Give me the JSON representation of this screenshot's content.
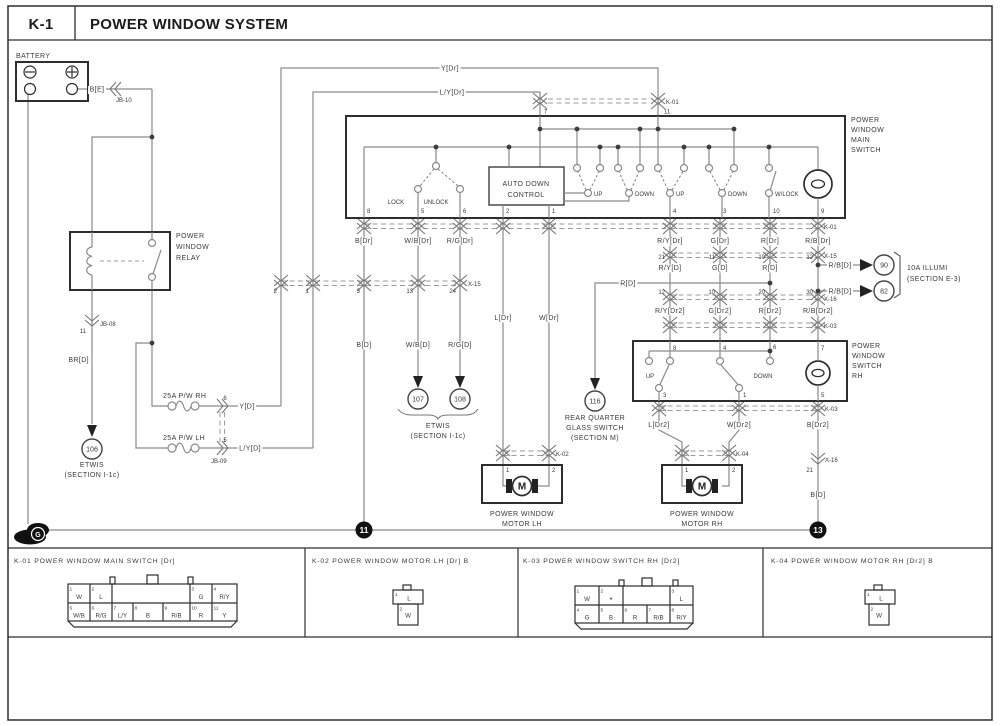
{
  "header": {
    "code": "K-1",
    "title": "POWER WINDOW SYSTEM"
  },
  "battery": {
    "label": "BATTERY",
    "wire_be": "B[E]",
    "jb10": "JB-10"
  },
  "relay": {
    "lines": [
      "POWER",
      "WINDOW",
      "RELAY"
    ],
    "jb08": "JB-08",
    "jb08_pin": "11",
    "wire_brd": "BR[D]"
  },
  "etwis106": {
    "num": "106",
    "lines": [
      "ETWIS",
      "(SECTION I-1c)"
    ]
  },
  "breakers": {
    "rh": "25A P/W RH",
    "lh": "25A P/W LH",
    "pin_rh": "6",
    "pin_lh": "5",
    "jb09": "JB-09",
    "wire_yd": "Y[D]",
    "wire_lyd": "L/Y[D]"
  },
  "top_wires": {
    "y_dr": "Y[Dr]",
    "ly_dr": "L/Y[Dr]"
  },
  "k01_top": {
    "label": "K-01",
    "pin7": "7",
    "pin11": "11"
  },
  "main_switch": {
    "lines": [
      "POWER",
      "WINDOW",
      "MAIN",
      "SWITCH"
    ],
    "lock": "LOCK",
    "unlock": "UNLOCK",
    "adc": [
      "AUTO DOWN",
      "CONTROL"
    ],
    "up": "UP",
    "down": "DOWN",
    "wlock": "W/LOCK",
    "bottom_pins": [
      "8",
      "5",
      "6",
      "2",
      "1",
      "4",
      "3",
      "10",
      "9"
    ]
  },
  "k01_bottom": {
    "label": "K-01"
  },
  "row_dr": [
    "B[Dr]",
    "W/B[Dr]",
    "R/G[Dr]",
    "R/Y[Dr]",
    "G[Dr]",
    "R[Dr]",
    "R/B[Dr]"
  ],
  "x15_left": {
    "label": "X-15",
    "pins": [
      "2",
      "1",
      "3",
      "13",
      "24"
    ]
  },
  "x15_right": {
    "label": "X-15",
    "pins": [
      "21",
      "11",
      "10",
      "12"
    ]
  },
  "row_d": [
    "R/Y[D]",
    "G[D]",
    "R[D]"
  ],
  "rb_d": "R/B[D]",
  "r_d": "R[D]",
  "illumi": {
    "n90": "90",
    "n82": "82",
    "lines": [
      "10A ILLUMI",
      "(SECTION E-3)"
    ]
  },
  "x16": {
    "label": "X-16",
    "pins": [
      "12",
      "10",
      "20",
      "30"
    ]
  },
  "row_dr2": [
    "R/Y[Dr2]",
    "G[Dr2]",
    "R[Dr2]",
    "R/B[Dr2]"
  ],
  "k03_top": {
    "label": "K-03"
  },
  "rh_switch": {
    "lines": [
      "POWER",
      "WINDOW",
      "SWITCH",
      "RH"
    ],
    "up": "UP",
    "down": "DOWN",
    "top_pins": [
      "8",
      "4",
      "6",
      "7"
    ],
    "bottom_pins": [
      "3",
      "1",
      "5"
    ]
  },
  "k03_bottom": {
    "label": "K-03"
  },
  "row_dr2b": [
    "L[Dr2]",
    "W[Dr2]",
    "B[Dr2]"
  ],
  "x16_single": {
    "label": "X-16",
    "pin": "21",
    "wire": "B[D]"
  },
  "left_drop": {
    "b_d": "B[D]",
    "wb_d": "W/B[D]",
    "rg_d": "R/G[D]",
    "l_dr": "L[Dr]",
    "w_dr": "W[Dr]"
  },
  "etwis_mid": {
    "n107": "107",
    "n108": "108",
    "lines": [
      "ETWIS",
      "(SECTION I-1c)"
    ]
  },
  "rear_quarter": {
    "num": "116",
    "lines": [
      "REAR QUARTER",
      "GLASS SWITCH",
      "(SECTION M)"
    ]
  },
  "k02": {
    "label": "K-02",
    "pins": [
      "1",
      "2"
    ]
  },
  "k04": {
    "label": "K-04",
    "pins": [
      "1",
      "2"
    ]
  },
  "motor_lh": {
    "m": "M",
    "lines": [
      "POWER WINDOW",
      "MOTOR LH"
    ]
  },
  "motor_rh": {
    "m": "M",
    "lines": [
      "POWER WINDOW",
      "MOTOR RH"
    ]
  },
  "ground": {
    "g": "G",
    "n11": "11",
    "n13": "13"
  },
  "footer": {
    "k01": {
      "title": "K-01 POWER WINDOW MAIN SWITCH [Dr]",
      "top": [
        {
          "n": "1",
          "c": "W"
        },
        {
          "n": "2",
          "c": "L"
        },
        {
          "n": "3",
          "c": "G"
        },
        {
          "n": "4",
          "c": "R/Y"
        }
      ],
      "bottom": [
        {
          "n": "5",
          "c": "W/B"
        },
        {
          "n": "6",
          "c": "R/G"
        },
        {
          "n": "7",
          "c": "L/Y"
        },
        {
          "n": "8",
          "c": "B"
        },
        {
          "n": "9",
          "c": "R/B"
        },
        {
          "n": "10",
          "c": "R"
        },
        {
          "n": "11",
          "c": "Y"
        }
      ]
    },
    "k02": {
      "title": "K-02 POWER WINDOW MOTOR LH [Dr] B",
      "pins": [
        {
          "n": "1",
          "c": "L"
        },
        {
          "n": "2",
          "c": "W"
        }
      ]
    },
    "k03": {
      "title": "K-03 POWER WINDOW SWITCH RH [Dr2]",
      "top": [
        {
          "n": "1",
          "c": "W"
        },
        {
          "n": "2",
          "c": "*"
        },
        {
          "n": "3",
          "c": "L"
        }
      ],
      "bottom": [
        {
          "n": "4",
          "c": "G"
        },
        {
          "n": "5",
          "c": "B"
        },
        {
          "n": "6",
          "c": "R"
        },
        {
          "n": "7",
          "c": "R/B"
        },
        {
          "n": "8",
          "c": "R/Y"
        }
      ]
    },
    "k04": {
      "title": "K-04 POWER WINDOW MOTOR RH [Dr2] B",
      "pins": [
        {
          "n": "1",
          "c": "L"
        },
        {
          "n": "2",
          "c": "W"
        }
      ]
    }
  }
}
